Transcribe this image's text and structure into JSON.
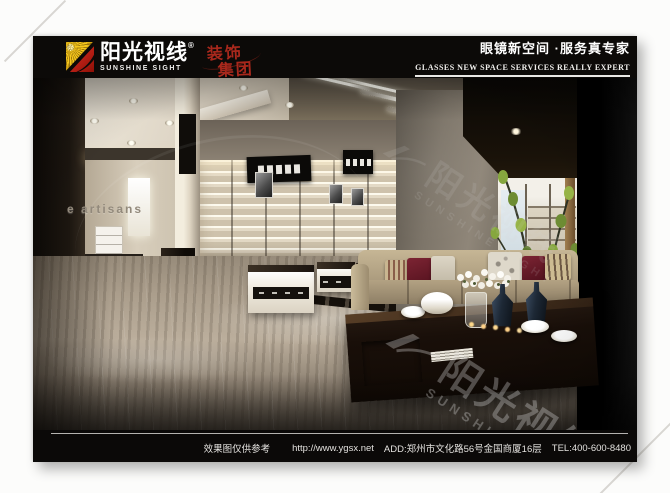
{
  "header": {
    "brand_cn": "阳光视线",
    "registered_mark": "®",
    "brand_en": "SUNSHINE SIGHT",
    "stamp": {
      "line1": "装饰",
      "line2": "集团"
    },
    "slogan_cn": "眼镜新空间 ·服务真专家",
    "slogan_en": "GLASSES NEW SPACE SERVICES REALLY EXPERT"
  },
  "scene": {
    "wall_brand_text": "e artisans"
  },
  "watermark": {
    "brand_cn": "阳光视线",
    "brand_en": "SUNSHINE SIGHT",
    "registered_mark": "®"
  },
  "footer": {
    "disclaimer": "效果图仅供参考",
    "url": "http://www.ygsx.net",
    "address": "ADD:郑州市文化路56号金国商厦16层",
    "tel": "TEL:400-600-8480"
  },
  "colors": {
    "band_black": "#0c0a08",
    "logo_yellow": "#f6c71c",
    "logo_red": "#c3241a",
    "stamp_red": "#a8281c",
    "floor_tan": "#ab9e8c",
    "sofa_beige": "#b3a283",
    "pillow_maroon": "#7c2433"
  }
}
